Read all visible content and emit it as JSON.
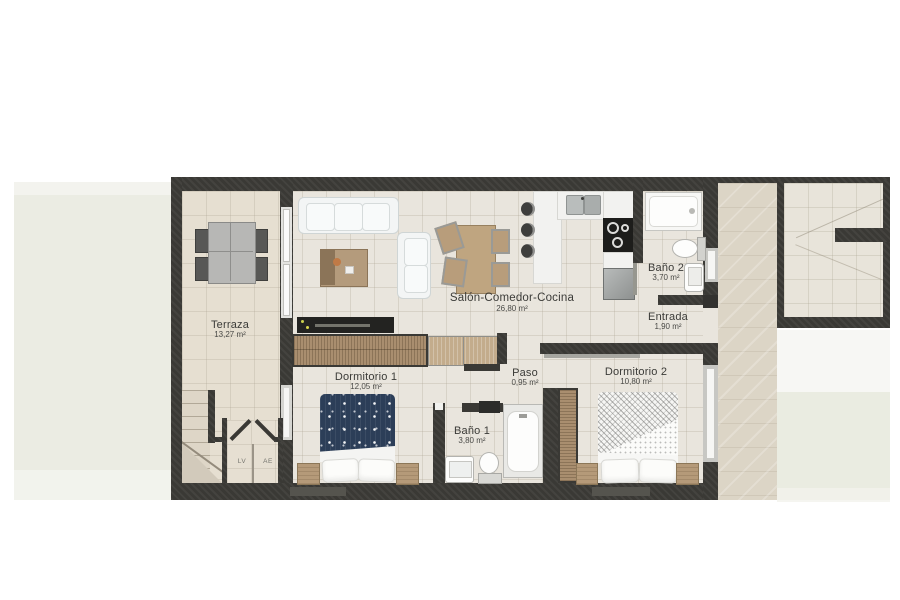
{
  "rooms": {
    "terraza": {
      "name": "Terraza",
      "area": "13,27 m²"
    },
    "salon": {
      "name": "Salón-Comedor-Cocina",
      "area": "26,80 m²"
    },
    "bano2": {
      "name": "Baño 2",
      "area": "3,70 m²"
    },
    "entrada": {
      "name": "Entrada",
      "area": "1,90 m²"
    },
    "dormitorio1": {
      "name": "Dormitorio 1",
      "area": "12,05 m²"
    },
    "paso": {
      "name": "Paso",
      "area": "0,95 m²"
    },
    "dormitorio2": {
      "name": "Dormitorio 2",
      "area": "10,80 m²"
    },
    "bano1": {
      "name": "Baño 1",
      "area": "3,80 m²"
    }
  },
  "closets": {
    "lv": "LV",
    "ae": "AE"
  },
  "colors": {
    "wall": "#3a3935",
    "floor": "#e9e5dd",
    "terrace_floor": "#e6dfd1",
    "corridor_floor": "#dcd5c6",
    "garden": "#ebece3",
    "wood": "#ab9174",
    "wood_light": "#c3ac8c",
    "navy_bedding": "#2c3e58",
    "furniture_white": "#f3f5f5",
    "label_text": "#3b3b38"
  }
}
